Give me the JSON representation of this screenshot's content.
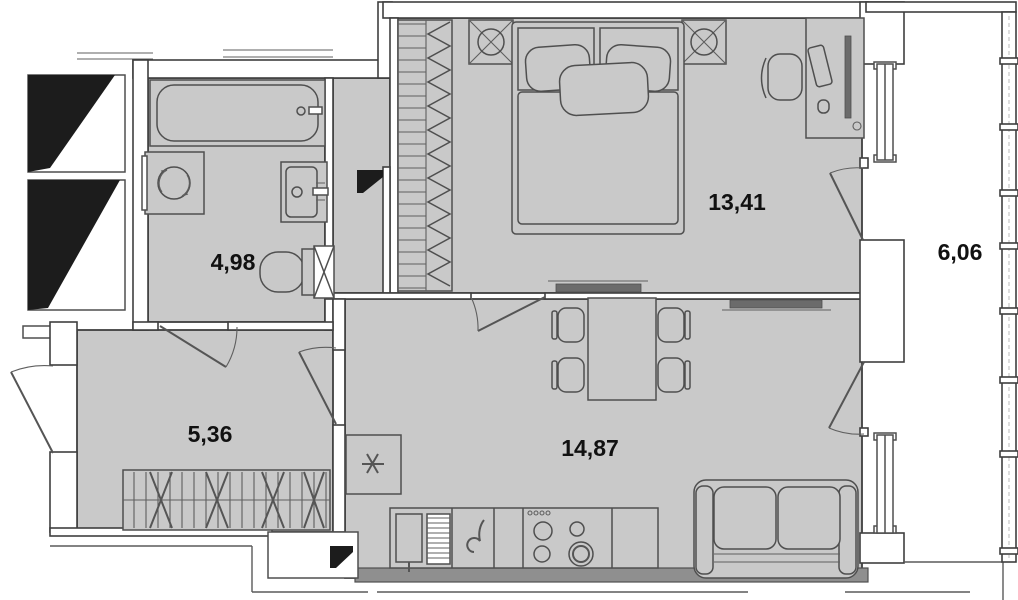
{
  "plan_type": "apartment-floor-plan",
  "rooms": {
    "bathroom": {
      "area": "4,98"
    },
    "hallway": {
      "area": "5,36"
    },
    "bedroom": {
      "area": "13,41"
    },
    "living_kitchen": {
      "area": "14,87"
    },
    "balcony": {
      "area": "6,06"
    }
  },
  "colors": {
    "floor": "#c9c9c9",
    "wall_fill": "#ffffff",
    "wall_line": "#3f3f3f",
    "dark_symbol": "#1c1c1c",
    "tv_fill": "#6b6b6b",
    "bottom_wall_band": "#8f8f8f"
  },
  "icons": [
    "bathtub-icon",
    "washing-machine-icon",
    "bathroom-sink-icon",
    "toilet-icon",
    "vent-duct-icon",
    "electrical-panel-icon",
    "wardrobe-icon",
    "bed-icon",
    "pillow-icon",
    "nightstand-lamp-icon",
    "desk-icon",
    "desk-chair-icon",
    "monitor-icon",
    "keyboard-icon",
    "mouse-icon",
    "dining-table-icon",
    "dining-chair-icon",
    "fridge-snowflake-icon",
    "dish-rack-icon",
    "kitchen-sink-icon",
    "stove-burner-icon",
    "sofa-icon",
    "tv-icon",
    "door-swing-icon",
    "window-icon",
    "balcony-glazing-icon",
    "shaft-icon"
  ]
}
